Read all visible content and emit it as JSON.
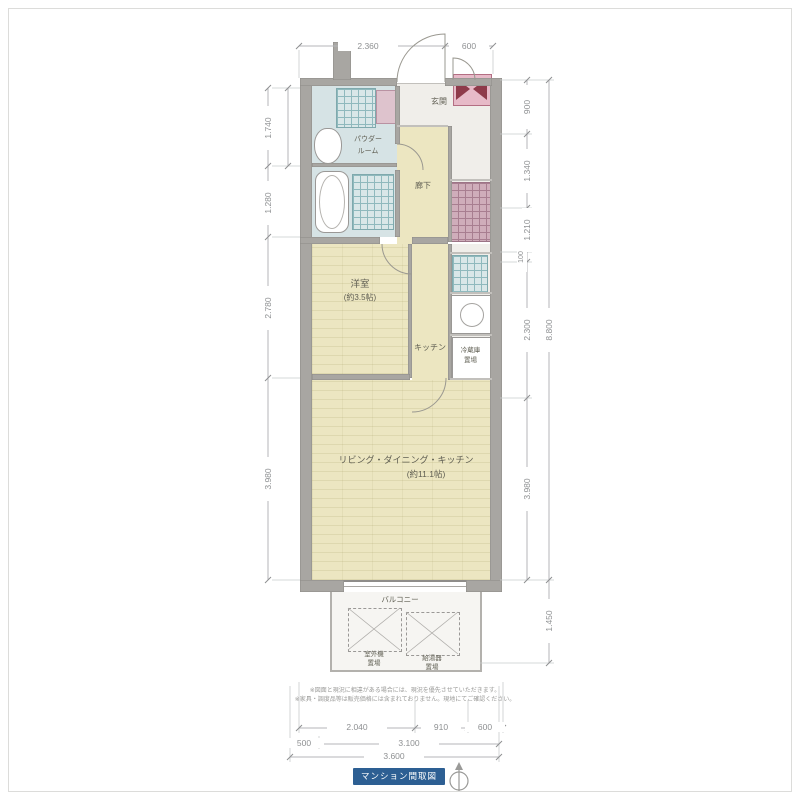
{
  "plan": {
    "rooms": {
      "powder_room": {
        "line1": "パウダー",
        "line2": "ルーム"
      },
      "hallway": {
        "name": "廊下"
      },
      "entrance": {
        "name": "玄関"
      },
      "bedroom": {
        "name": "洋室",
        "size": "(約3.5帖)"
      },
      "kitchen": {
        "name": "キッチン"
      },
      "ldk": {
        "name": "リビング・ダイニング・キッチン",
        "size": "(約11.1帖)"
      },
      "balcony": {
        "name": "バルコニー"
      },
      "fridge_space": {
        "line1": "冷蔵庫",
        "line2": "置場"
      },
      "outdoor_unit": {
        "line1": "室外機",
        "line2": "置場"
      },
      "water_heater": {
        "line1": "給湯器",
        "line2": "置場"
      }
    },
    "dimensions": {
      "top": [
        "2.360",
        "600"
      ],
      "left": [
        "1.740",
        "1.280",
        "2.780",
        "3.980"
      ],
      "right": [
        "900",
        "1.340",
        "1.210",
        "100",
        "2.300",
        "3.980"
      ],
      "right_overall": [
        "8.800",
        "1.450"
      ],
      "bottom_row1": [
        "2.040",
        "910",
        "600"
      ],
      "bottom_row2": [
        "500",
        "3.100"
      ],
      "bottom_row3": [
        "3.600"
      ]
    },
    "notes": [
      "※図面と現況に相違がある場合には、現況を優先させていただきます。",
      "※家具・調度品等は販売価格には含まれておりません。現地にてご確認ください。"
    ]
  },
  "footer": {
    "banner_text": "マンション間取図"
  },
  "colors": {
    "room_yellow": "#ece6c1",
    "room_blue": "#d6e3e5",
    "wall_gray": "#a8a6a2",
    "mb_pink": "#e7bac8",
    "mb_accent": "#8e3a4a",
    "banner_blue": "#2d5f93"
  }
}
